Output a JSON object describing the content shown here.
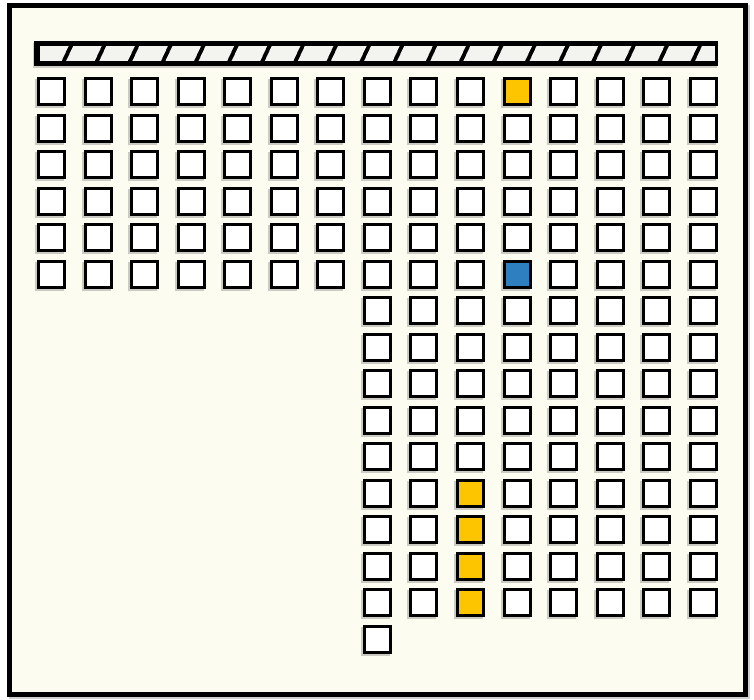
{
  "scene": {
    "kind": "room-layout-grid",
    "background_color": "#FCFCF0",
    "frame_color": "#000000"
  },
  "hatched_bar": {
    "pattern": "diagonal-stripes",
    "fill_color": "#F3F3EF",
    "stripe_color": "#000000",
    "stripe_count": 21
  },
  "grid": {
    "columns": 15,
    "rows": 16,
    "total_cells": 163,
    "cell_colors": {
      "default": "#FFFFFF",
      "yellow": "#FCC500",
      "blue": "#2E7FBF",
      "border": "#000000"
    },
    "sections": [
      {
        "name": "upper-block",
        "row_start": 1,
        "row_end": 6,
        "col_start": 1,
        "col_end": 15
      },
      {
        "name": "lower-right-block",
        "row_start": 7,
        "row_end": 15,
        "col_start": 8,
        "col_end": 15
      },
      {
        "name": "bottom-single-cell",
        "row_start": 16,
        "row_end": 16,
        "col_start": 8,
        "col_end": 8
      }
    ],
    "highlighted_cells": [
      {
        "row": 1,
        "col": 11,
        "state": "yellow"
      },
      {
        "row": 6,
        "col": 11,
        "state": "blue"
      },
      {
        "row": 12,
        "col": 10,
        "state": "yellow"
      },
      {
        "row": 13,
        "col": 10,
        "state": "yellow"
      },
      {
        "row": 14,
        "col": 10,
        "state": "yellow"
      },
      {
        "row": 15,
        "col": 10,
        "state": "yellow"
      }
    ]
  }
}
